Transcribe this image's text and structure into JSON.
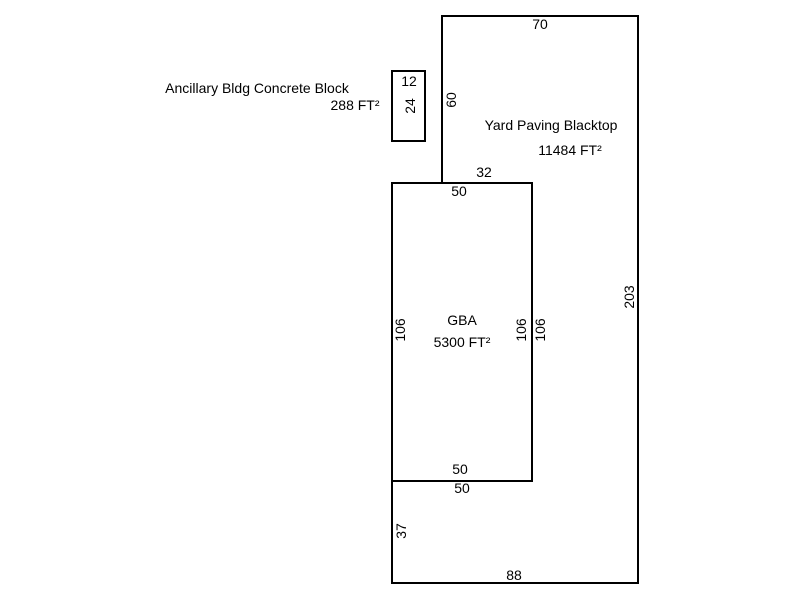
{
  "sketch": {
    "background": "#ffffff",
    "line_color": "#000000",
    "text_color": "#000000",
    "areas": {
      "ancillary": {
        "name": "Ancillary Bldg Concrete Block",
        "area": "288 FT²",
        "dims": {
          "width": "12",
          "height": "24"
        }
      },
      "yard": {
        "name": "Yard Paving Blacktop",
        "area": "11484 FT²",
        "dims": {
          "top": "70",
          "upper_left": "60",
          "notch_top": "32",
          "inner_right": "106",
          "notch_bottom": "50",
          "lower_left": "37",
          "bottom": "88",
          "right": "203"
        }
      },
      "gba": {
        "name": "GBA",
        "area": "5300 FT²",
        "dims": {
          "top": "50",
          "left": "106",
          "right": "106",
          "bottom": "50"
        }
      }
    }
  }
}
